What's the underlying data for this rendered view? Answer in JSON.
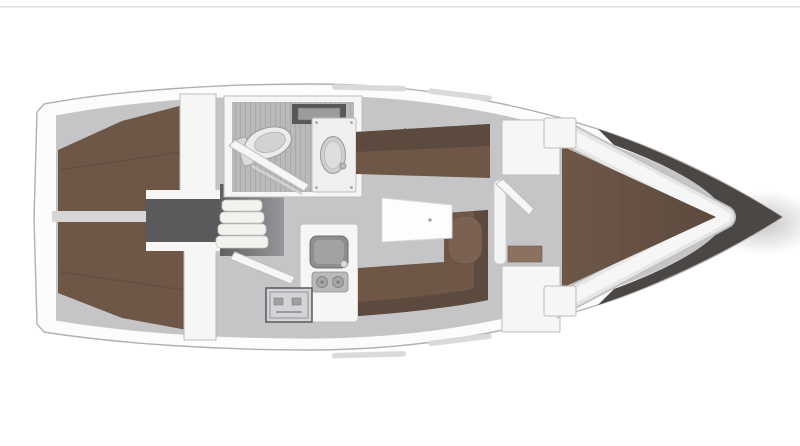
{
  "layout_info": {
    "type": "sailboat-interior-floor-plan",
    "view": "top-down",
    "bow_direction": "right",
    "areas": [
      "aft-cabin-port-berth",
      "aft-cabin-starboard-berth",
      "companionway",
      "head-wet-room",
      "galley",
      "saloon",
      "forward-v-berth-cabin"
    ],
    "fixtures": [
      "toilet",
      "washbasin",
      "shower-grating",
      "head-locker",
      "galley-sink",
      "two-burner-stove",
      "oven",
      "saloon-table",
      "port-settee",
      "starboard-settee",
      "mast-post",
      "companionway-steps",
      "engine-box",
      "wardrobe",
      "forward-locker",
      "v-berth"
    ]
  },
  "colors": {
    "background": "#ffffff",
    "top_rule": "#d9d9d9",
    "hull_fill": "#fcfcfc",
    "hull_outline": "#b0b0b0",
    "deck_line": "#c9c9c9",
    "floor": "#c5c5c7",
    "floor_dark": "#b9b9bb",
    "bow_dark": "#4a4744",
    "berth_brown": "#6e5747",
    "berth_brown_dark": "#5d4a3e",
    "berth_tip_dark": "#50403700",
    "berth_seam": "#5f4c40",
    "berth_roll": "#7a6151",
    "wood_step": "#8b7260",
    "divider_gray": "#d7d7d8",
    "engine_gray": "#5a5a5c",
    "comp_dark": "#606062",
    "comp_light": "#97979a",
    "step_white": "#f3f2ee",
    "wall_white": "#f6f6f5",
    "fixture_white": "#efefef",
    "fixture_outline": "#bdbdbd",
    "sink_gray": "#8e8e90",
    "sink_inner": "#a2a2a4",
    "burner_gray": "#b9b9ba",
    "slat_gray": "#a9a9ab",
    "table_white": "#fdfdfd",
    "post_white": "#f4f4f4",
    "toilet_white": "#ececec",
    "window_strip": "#dadada"
  }
}
